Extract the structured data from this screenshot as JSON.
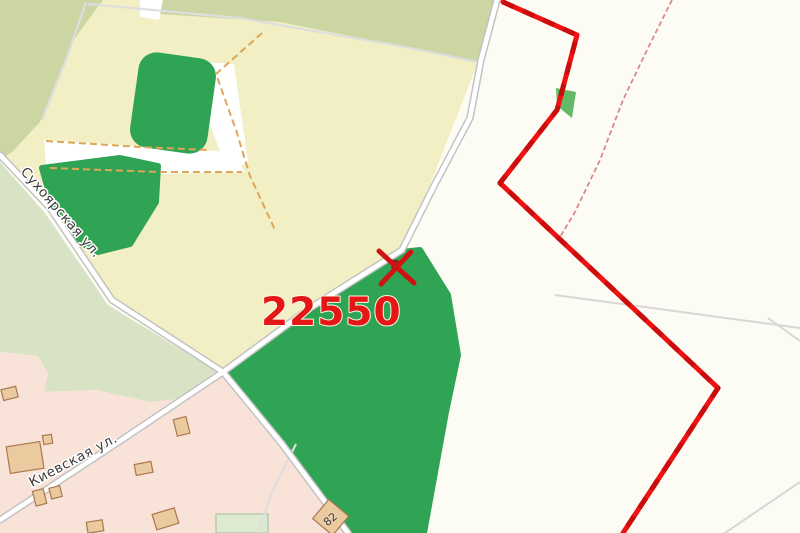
{
  "map": {
    "parcel": {
      "label": "22550"
    },
    "streets": [
      {
        "name": "Сухоярская ул."
      },
      {
        "name": "Киевская ул."
      }
    ],
    "building_number": "82",
    "colors": {
      "background": "#fcfbf4",
      "field": "#f2efc4",
      "scrub": "#cbd6a3",
      "meadow": "#d8e3c5",
      "forest": "#2fa454",
      "forest_patch": "#63b968",
      "residential": "#f9e2d8",
      "clearing": "#ffffff",
      "lawn": "#dcead0",
      "parcel_boundary": "#ee1212",
      "parcel_boundary_dark": "#c90d0d",
      "boundary_thin": "#d98b84",
      "building_fill": "#ecca9f",
      "marker_red": "#cf1212",
      "marker_core": "#7e2a1e",
      "label_red": "#e41616"
    }
  }
}
